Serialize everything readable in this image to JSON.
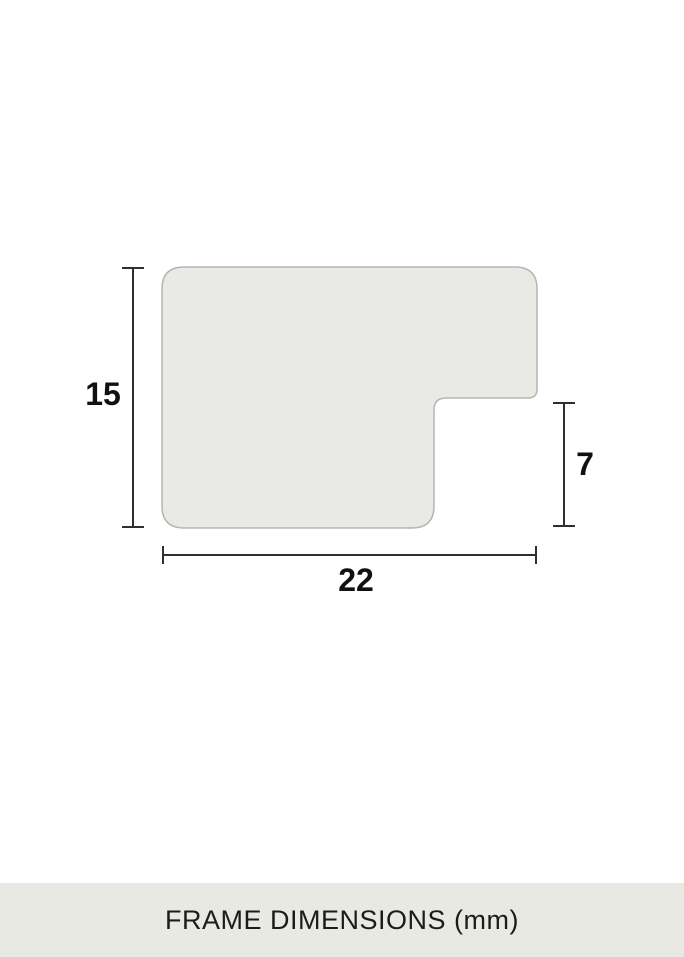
{
  "diagram": {
    "dimensions": {
      "height_label": "15",
      "rabbet_label": "7",
      "width_label": "22"
    },
    "caption": "FRAME DIMENSIONS (mm)",
    "colors": {
      "shape_fill": "#e9e9e5",
      "shape_border": "#b5b5b0",
      "dimension_line": "#2f2f2f",
      "label_text": "#111111",
      "caption_text": "#1c1c1c",
      "caption_bg": "#e9e9e4",
      "page_bg": "#ffffff"
    }
  }
}
